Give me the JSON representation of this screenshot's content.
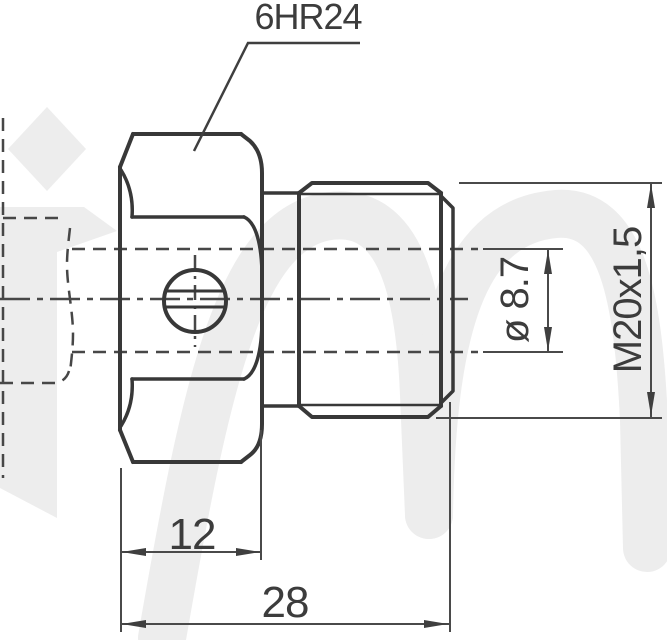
{
  "drawing": {
    "callout": "6HR24",
    "dim_hex_width": "12",
    "dim_overall_length": "28",
    "dim_bore": "ø 8.7",
    "dim_thread": "M20x1,5",
    "colors": {
      "line": "#3a3a3a",
      "dimension_line": "#4a4a4a",
      "text": "#3c3c3c",
      "watermark": "#ededed",
      "background": "#ffffff"
    }
  }
}
